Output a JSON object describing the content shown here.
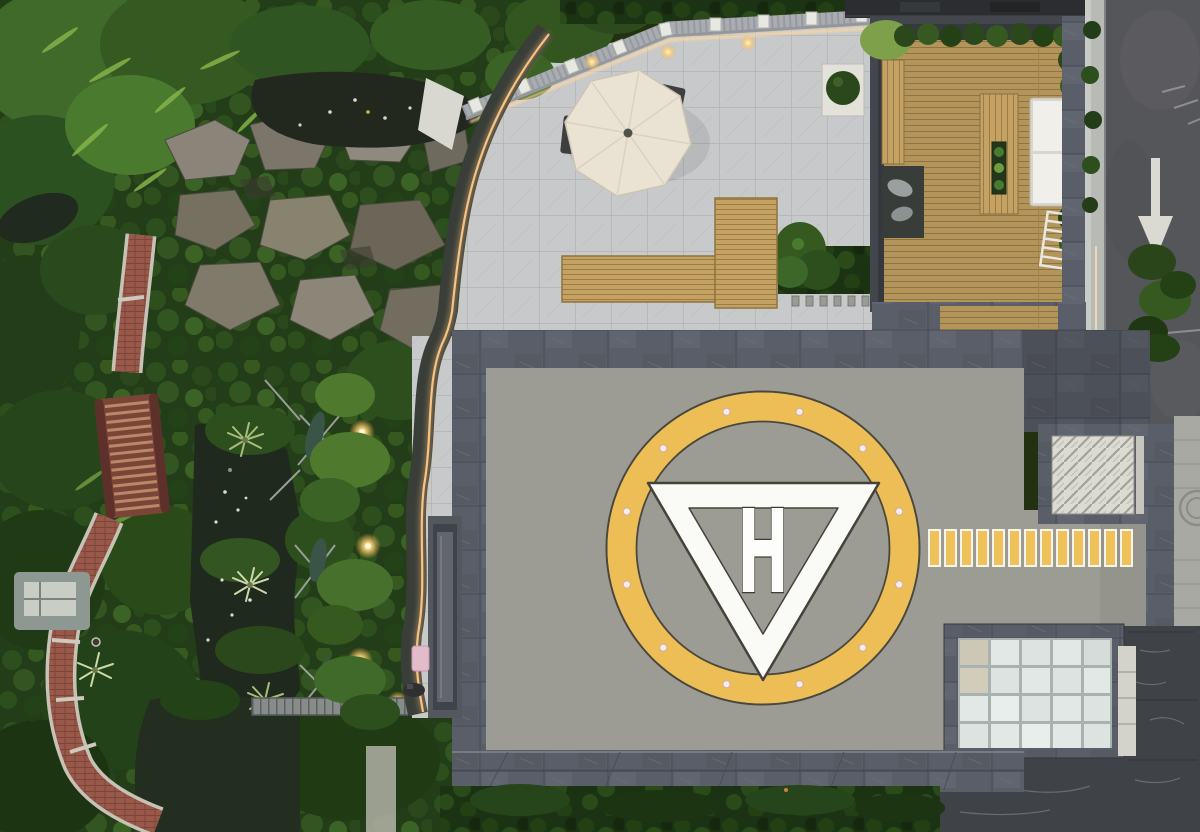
{
  "scene": {
    "description": "Aerial drone view of a rooftop helipad beside a landscaped roof garden, stone terrace with patio umbrella, timber deck and a service road",
    "lighting": "dusk with warm LED landscape lighting on"
  },
  "helipad": {
    "marking_letter": "H",
    "perimeter_light_count": 12,
    "walkway_stripe_count": 13
  },
  "colors": {
    "helipad_ring": "#ECBE55",
    "helipad_surface": "#9C9B94",
    "triangle_marking": "#FAFAF7",
    "walkway_stripe": "#EEC258",
    "parapet_slate": "#5A5E68",
    "terrace_paving": "#C7C9CA",
    "deck_wood": "#B49459",
    "road_asphalt": "#55565A",
    "road_marking": "#DADAD2",
    "foliage_dark": "#223D18",
    "foliage_light": "#6F9C3F",
    "pond_water": "#23281F",
    "brick_path": "#99594A",
    "led_accent": "#FFC884",
    "umbrella_canopy": "#EAE3D4"
  }
}
